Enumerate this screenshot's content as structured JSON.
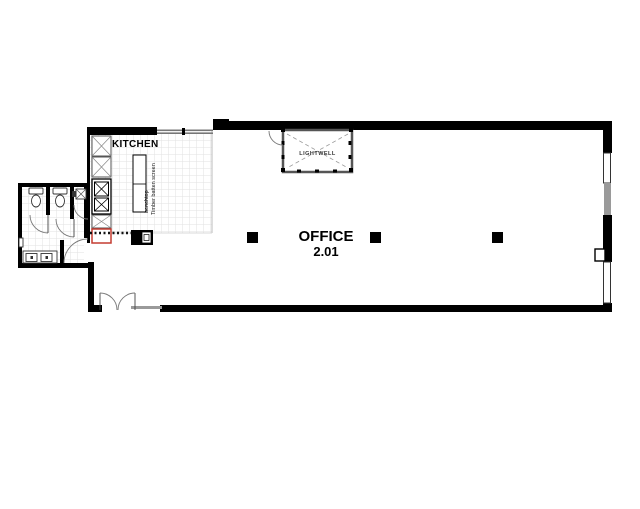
{
  "plan": {
    "room": {
      "name": "OFFICE",
      "number": "2.01"
    },
    "kitchen_label": "KITCHEN",
    "lightwell_label": "LIGHTWELL",
    "island_labels": {
      "screen": "Timber batten screen",
      "bench": "benchtop"
    },
    "colors": {
      "wall": "#000000",
      "window_gray": "#9a9a9a",
      "tile_line": "#e2e2e2",
      "accent_red": "#c43c31",
      "door_arc": "#777777",
      "dash_line": "#111111"
    }
  }
}
